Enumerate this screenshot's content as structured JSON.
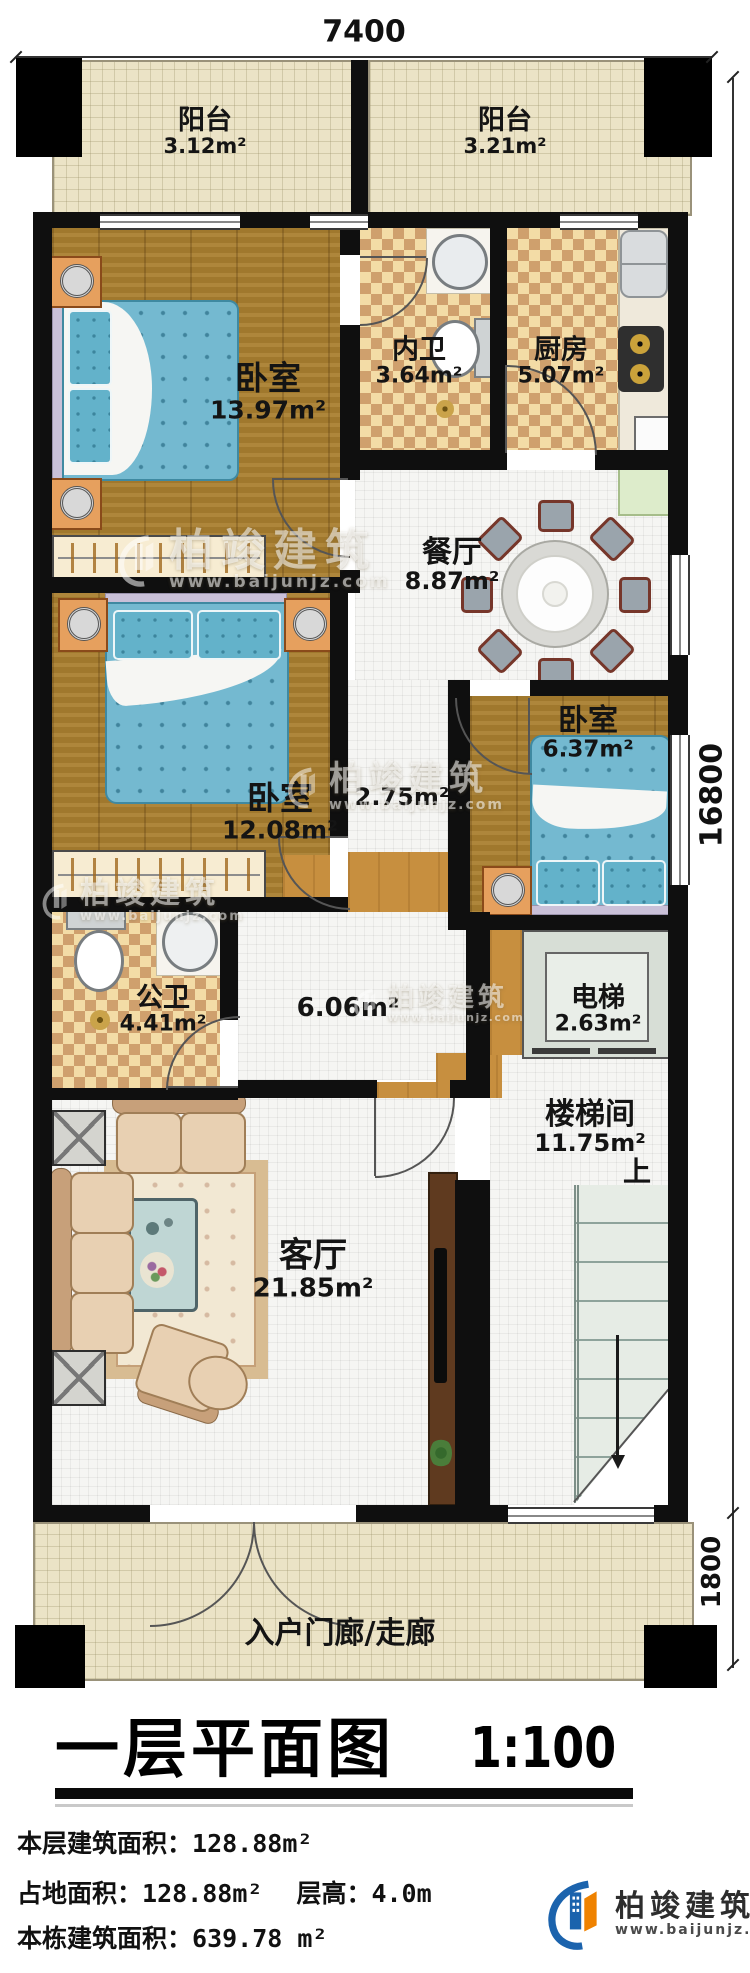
{
  "dimensions": {
    "top": "7400",
    "side_main": "16800",
    "side_porch": "1800"
  },
  "rooms": [
    {
      "name": "阳台",
      "area": "3.12m²"
    },
    {
      "name": "阳台",
      "area": "3.21m²"
    },
    {
      "name": "卧室",
      "area": "13.97m²"
    },
    {
      "name": "内卫",
      "area": "3.64m²"
    },
    {
      "name": "厨房",
      "area": "5.07m²"
    },
    {
      "name": "餐厅",
      "area": "8.87m²"
    },
    {
      "name": "卧室",
      "area": "12.08m²"
    },
    {
      "name": "卧室",
      "area": "6.37m²"
    },
    {
      "name": "",
      "area": "2.75m²"
    },
    {
      "name": "公卫",
      "area": "4.41m²"
    },
    {
      "name": "",
      "area": "6.06m²"
    },
    {
      "name": "电梯",
      "area": "2.63m²"
    },
    {
      "name": "楼梯间",
      "area": "11.75m²"
    },
    {
      "name": "客厅",
      "area": "21.85m²"
    },
    {
      "name": "入户门廊/走廊",
      "area": ""
    }
  ],
  "labels": {
    "up": "上"
  },
  "title": {
    "text": "一层平面图",
    "scale": "1:100"
  },
  "footer": {
    "line1_label": "本层建筑面积：",
    "line1_value": "128.88m²",
    "line2_label": "占地面积：",
    "line2_value": "128.88m²",
    "line2b_label": "层高：",
    "line2b_value": "4.0m",
    "line3_label": "本栋建筑面积：",
    "line3_value": "639.78 m²"
  },
  "brand": {
    "name": "柏竣建筑",
    "url": "www.baijunjz.com"
  },
  "colors": {
    "wall": "#0f0f0f",
    "wood": "#a97e2f",
    "bed": "#74b9d0",
    "accent_blue": "#1b63ad",
    "accent_orange": "#ef8200"
  }
}
